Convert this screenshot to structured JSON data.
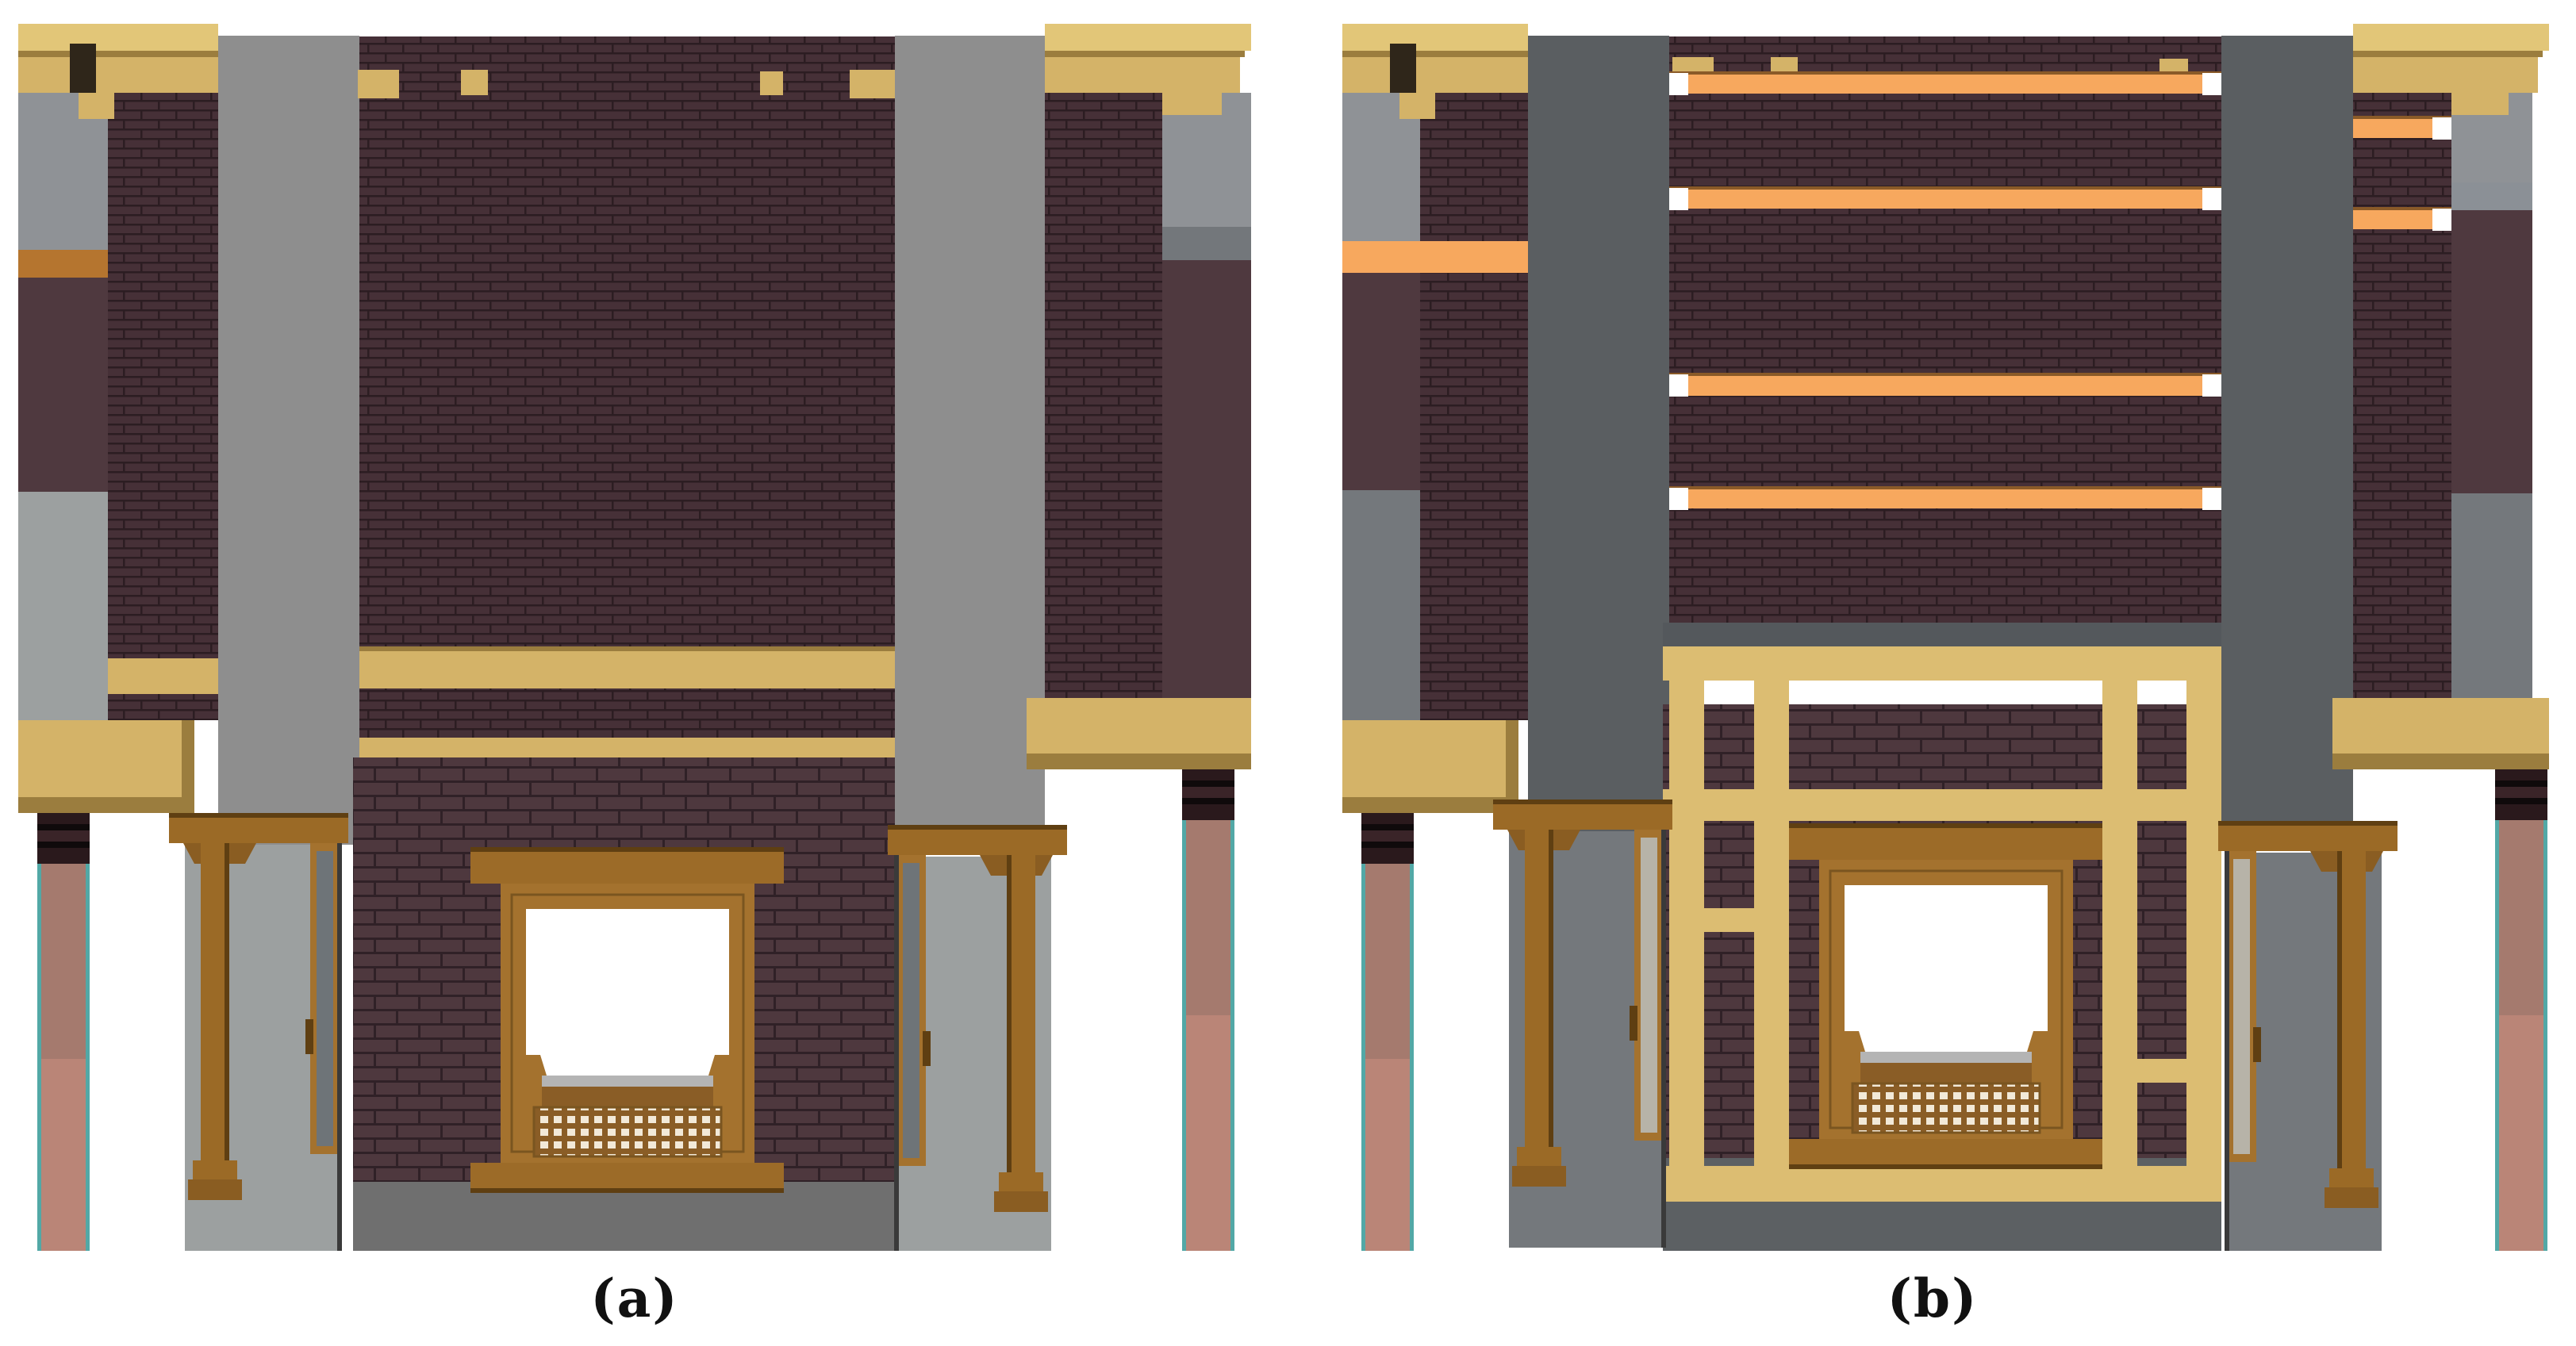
{
  "figure": {
    "panels": [
      {
        "id": "a",
        "label": "(a)"
      },
      {
        "id": "b",
        "label": "(b)"
      }
    ]
  },
  "colors": {
    "bg": "#ffffff",
    "caption": "#111111",
    "tan": "#d4b368",
    "tanlight": "#e2c678",
    "tanedge": "#9b7d3e",
    "notchdark": "#2f261a",
    "khaki": "#dcbd72",
    "orange": "#f7a85e",
    "orangedge": "#8a5a28",
    "orangebrown": "#b5752f",
    "bricku": "#463037",
    "brickumortar": "#2c1d22",
    "brickl": "#4e383e",
    "bricklmortar": "#302127",
    "plum": "#4f393f",
    "graya": "#8e8e8e",
    "grayareturn": "#8f9296",
    "grayaband": "#73777b",
    "porcha": "#9ca0a0",
    "basea": "#6f6f6f",
    "grayb": "#5a5e61",
    "porchb": "#74787c",
    "baseb": "#5c6063",
    "graybband": "#8b9096",
    "shadowb": "#54585c",
    "winbrown": "#a4722e",
    "windark": "#7a5520",
    "lintel": "#9c6b28",
    "latticebg": "#8a5d26",
    "latticehole": "#f2e9d8",
    "pane": "#ffffff",
    "sillline": "#b4b4b4",
    "postbrown": "#9b6a26",
    "postdark": "#5f3f12",
    "capbrown": "#8a5d22",
    "colteal": "#52a8a6",
    "colpink": "#a57a6e",
    "colsalmon": "#ba8577",
    "capdark1": "#2a191c",
    "capdark2": "#0f0a0b",
    "capmid": "#3a2428",
    "leafa": "#6e7478",
    "doorleaf": "#b7b3a8"
  }
}
